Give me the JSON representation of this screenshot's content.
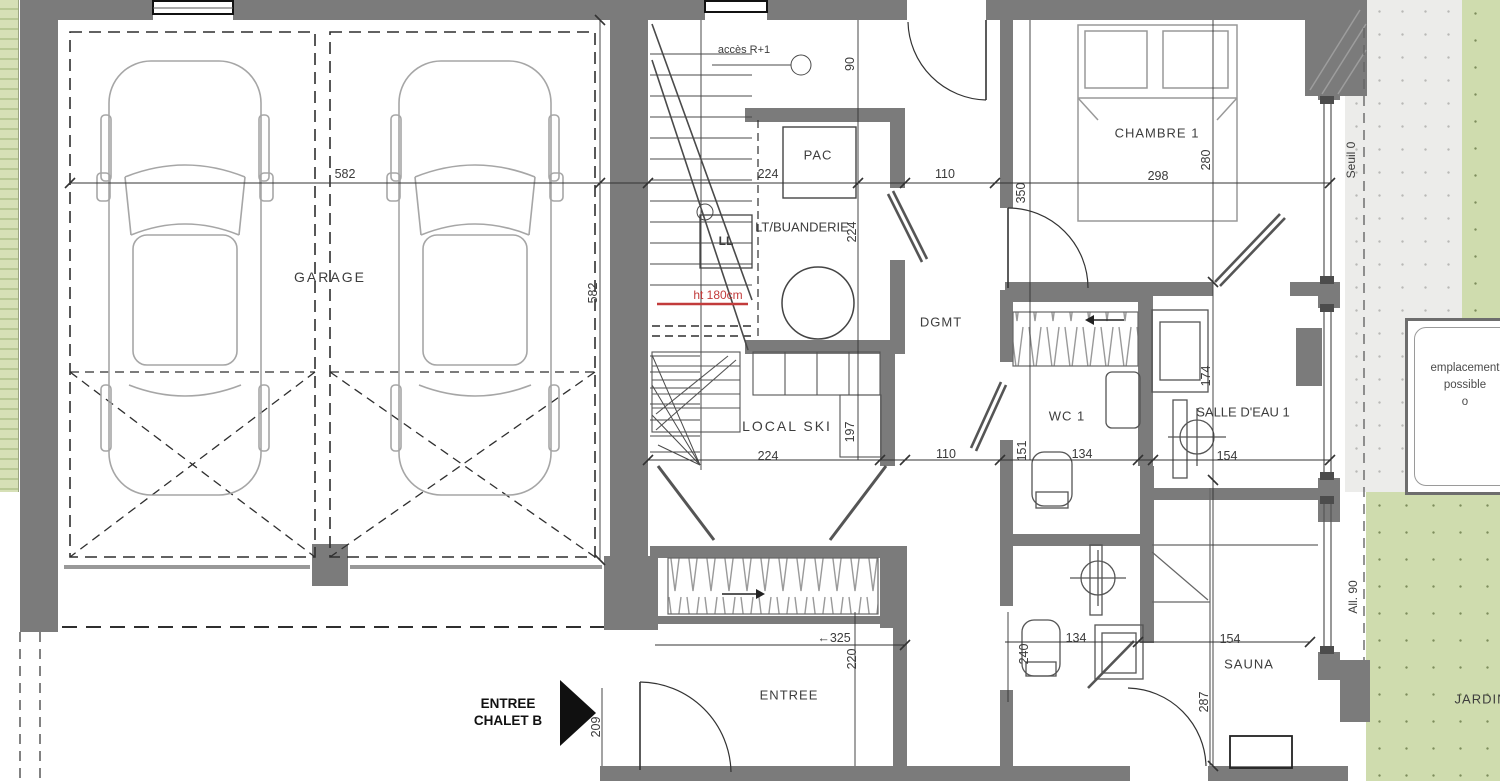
{
  "colors": {
    "wall": "#7b7b7b",
    "line": "#3f3f3f",
    "car_outline": "#a6a6a6",
    "green": "#cfdcae",
    "terrace": "#ececea",
    "red_note": "#c23b3b"
  },
  "rooms": [
    {
      "id": "garage",
      "label": "GARAGE",
      "x": 330,
      "y": 277,
      "fs": 14,
      "ls": 2
    },
    {
      "id": "acces-r1",
      "label": "accès R+1",
      "x": 744,
      "y": 50,
      "fs": 11,
      "ls": 0
    },
    {
      "id": "pac",
      "label": "PAC",
      "x": 818,
      "y": 155,
      "fs": 13,
      "ls": 1
    },
    {
      "id": "lt-buanderie",
      "label": "LT/BUANDERIE",
      "x": 802,
      "y": 227,
      "fs": 13,
      "ls": 0
    },
    {
      "id": "ll",
      "label": "LL",
      "x": 726,
      "y": 241,
      "fs": 12,
      "ls": 0,
      "bold": 1
    },
    {
      "id": "local-ski",
      "label": "LOCAL SKI",
      "x": 787,
      "y": 426,
      "fs": 14,
      "ls": 2
    },
    {
      "id": "dgmt",
      "label": "DGMT",
      "x": 941,
      "y": 322,
      "fs": 13,
      "ls": 1
    },
    {
      "id": "wc-1",
      "label": "WC 1",
      "x": 1067,
      "y": 416,
      "fs": 13,
      "ls": 1
    },
    {
      "id": "salle-eau-1",
      "label": "SALLE D'EAU 1",
      "x": 1243,
      "y": 412,
      "fs": 13,
      "ls": 0
    },
    {
      "id": "chambre-1",
      "label": "CHAMBRE 1",
      "x": 1157,
      "y": 133,
      "fs": 13,
      "ls": 1
    },
    {
      "id": "entree",
      "label": "ENTREE",
      "x": 789,
      "y": 695,
      "fs": 13,
      "ls": 1
    },
    {
      "id": "sauna",
      "label": "SAUNA",
      "x": 1249,
      "y": 664,
      "fs": 13,
      "ls": 1
    },
    {
      "id": "jardin",
      "label": "JARDIN",
      "x": 1481,
      "y": 699,
      "fs": 13,
      "ls": 1
    }
  ],
  "dimensions": [
    {
      "v": "582",
      "x": 345,
      "y": 174
    },
    {
      "v": "224",
      "x": 768,
      "y": 174
    },
    {
      "v": "110",
      "x": 945,
      "y": 174
    },
    {
      "v": "298",
      "x": 1158,
      "y": 176
    },
    {
      "v": "582",
      "x": 593,
      "y": 293,
      "rot": 1
    },
    {
      "v": "90",
      "x": 850,
      "y": 64,
      "rot": 1
    },
    {
      "v": "350",
      "x": 1021,
      "y": 193,
      "rot": 1
    },
    {
      "v": "280",
      "x": 1206,
      "y": 160,
      "rot": 1
    },
    {
      "v": "224",
      "x": 852,
      "y": 232,
      "rot": 1
    },
    {
      "v": "224",
      "x": 768,
      "y": 456
    },
    {
      "v": "197",
      "x": 850,
      "y": 432,
      "rot": 1
    },
    {
      "v": "110",
      "x": 946,
      "y": 454
    },
    {
      "v": "151",
      "x": 1022,
      "y": 451,
      "rot": 1
    },
    {
      "v": "134",
      "x": 1082,
      "y": 454
    },
    {
      "v": "174",
      "x": 1206,
      "y": 376,
      "rot": 1
    },
    {
      "v": "154",
      "x": 1227,
      "y": 456
    },
    {
      "v": "←325",
      "x": 834,
      "y": 638
    },
    {
      "v": "220",
      "x": 852,
      "y": 659,
      "rot": 1
    },
    {
      "v": "209",
      "x": 596,
      "y": 727,
      "rot": 1
    },
    {
      "v": "240",
      "x": 1024,
      "y": 654,
      "rot": 1
    },
    {
      "v": "134",
      "x": 1076,
      "y": 638
    },
    {
      "v": "154",
      "x": 1230,
      "y": 639
    },
    {
      "v": "287",
      "x": 1204,
      "y": 702,
      "rot": 1
    }
  ],
  "annotations": {
    "ht180": "ht 180cm",
    "seuil": "Seuil 0",
    "allege": "All. 90",
    "entree_chalet_line1": "ENTREE",
    "entree_chalet_line2": "CHALET B",
    "emplacement": {
      "line1": "emplacement",
      "line2": "possible",
      "line3": "o"
    }
  }
}
